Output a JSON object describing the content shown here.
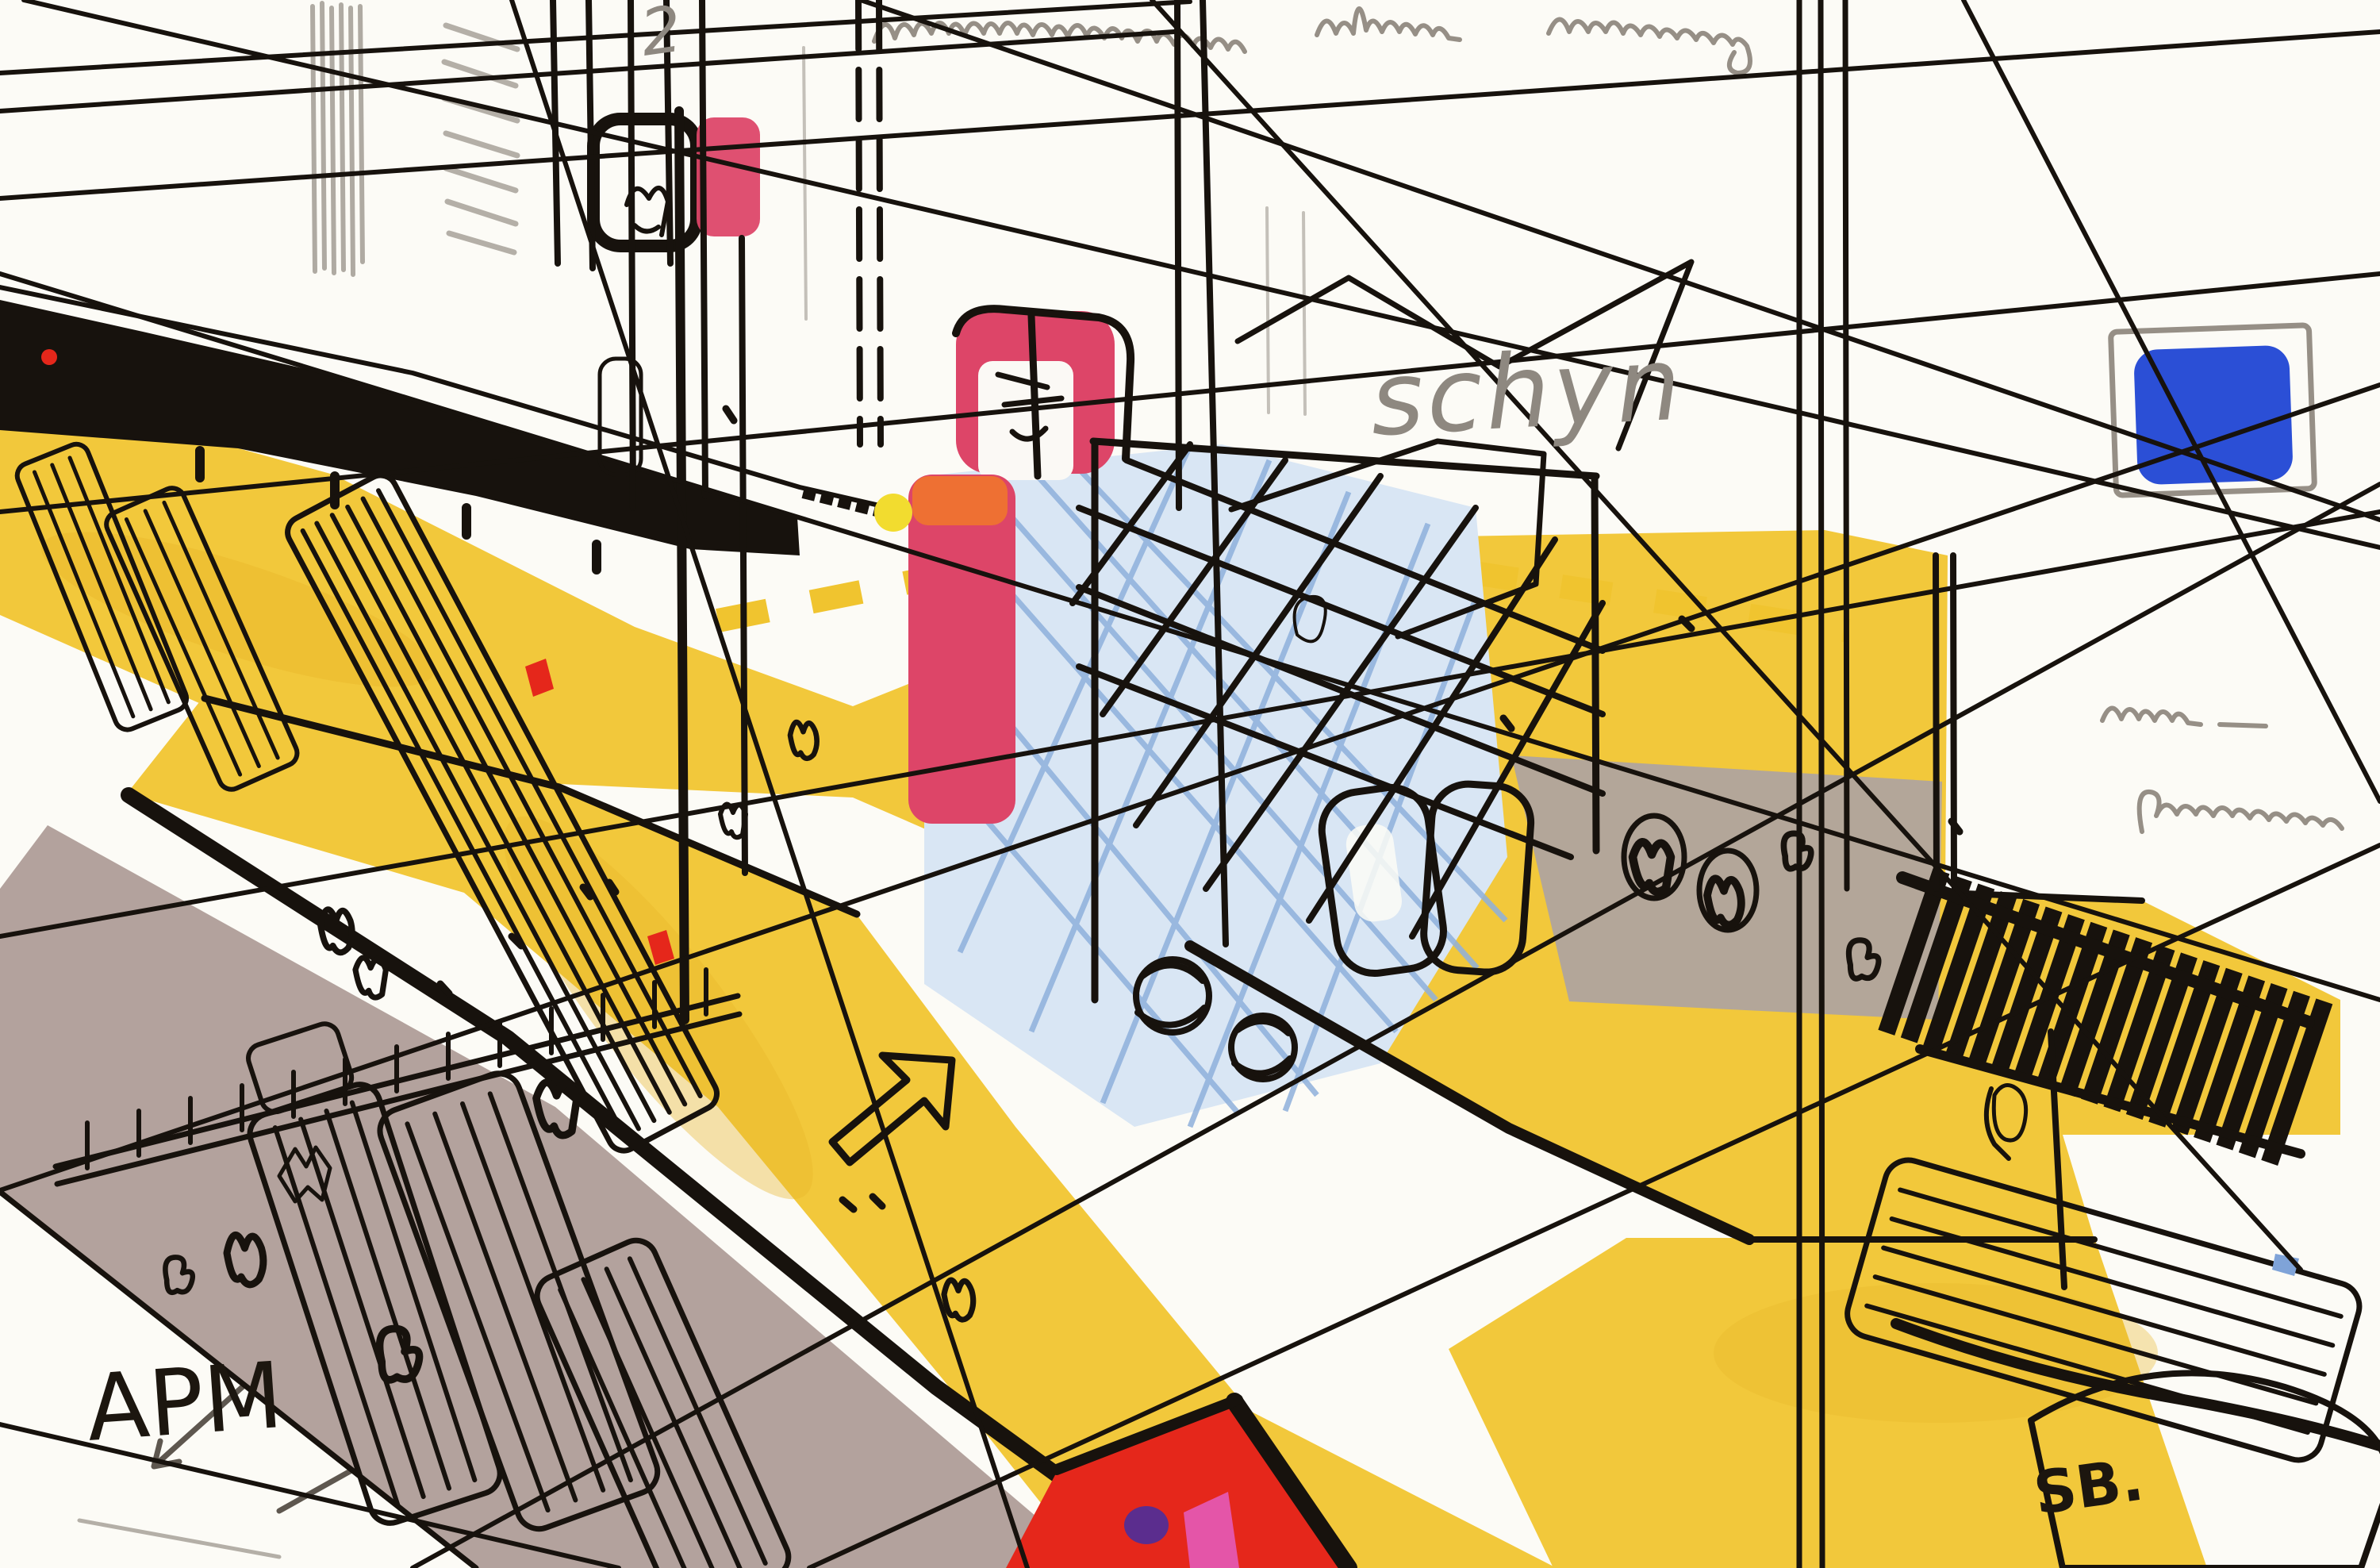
{
  "artwork": {
    "annotations": {
      "numeral_top": "2",
      "pencil_word": "schyn",
      "ground_label": "APM",
      "signature": "SB."
    },
    "palette": {
      "paper": "#FCFBF6",
      "ink_black": "#17120D",
      "pencil_gray": "#968F86",
      "marker_yellow": "#F2C83B",
      "marker_yellow_deep": "#E8B62B",
      "marker_mauve": "#B3A29D",
      "marker_crimson": "#DD4568",
      "marker_pink": "#EE6FA0",
      "marker_magenta": "#E455A8",
      "marker_red": "#E5271B",
      "marker_orange": "#F0742E",
      "marker_blue": "#2B4FD6",
      "pool_blue": "#A9C3E4",
      "accent_purple": "#5B2D8E"
    }
  }
}
